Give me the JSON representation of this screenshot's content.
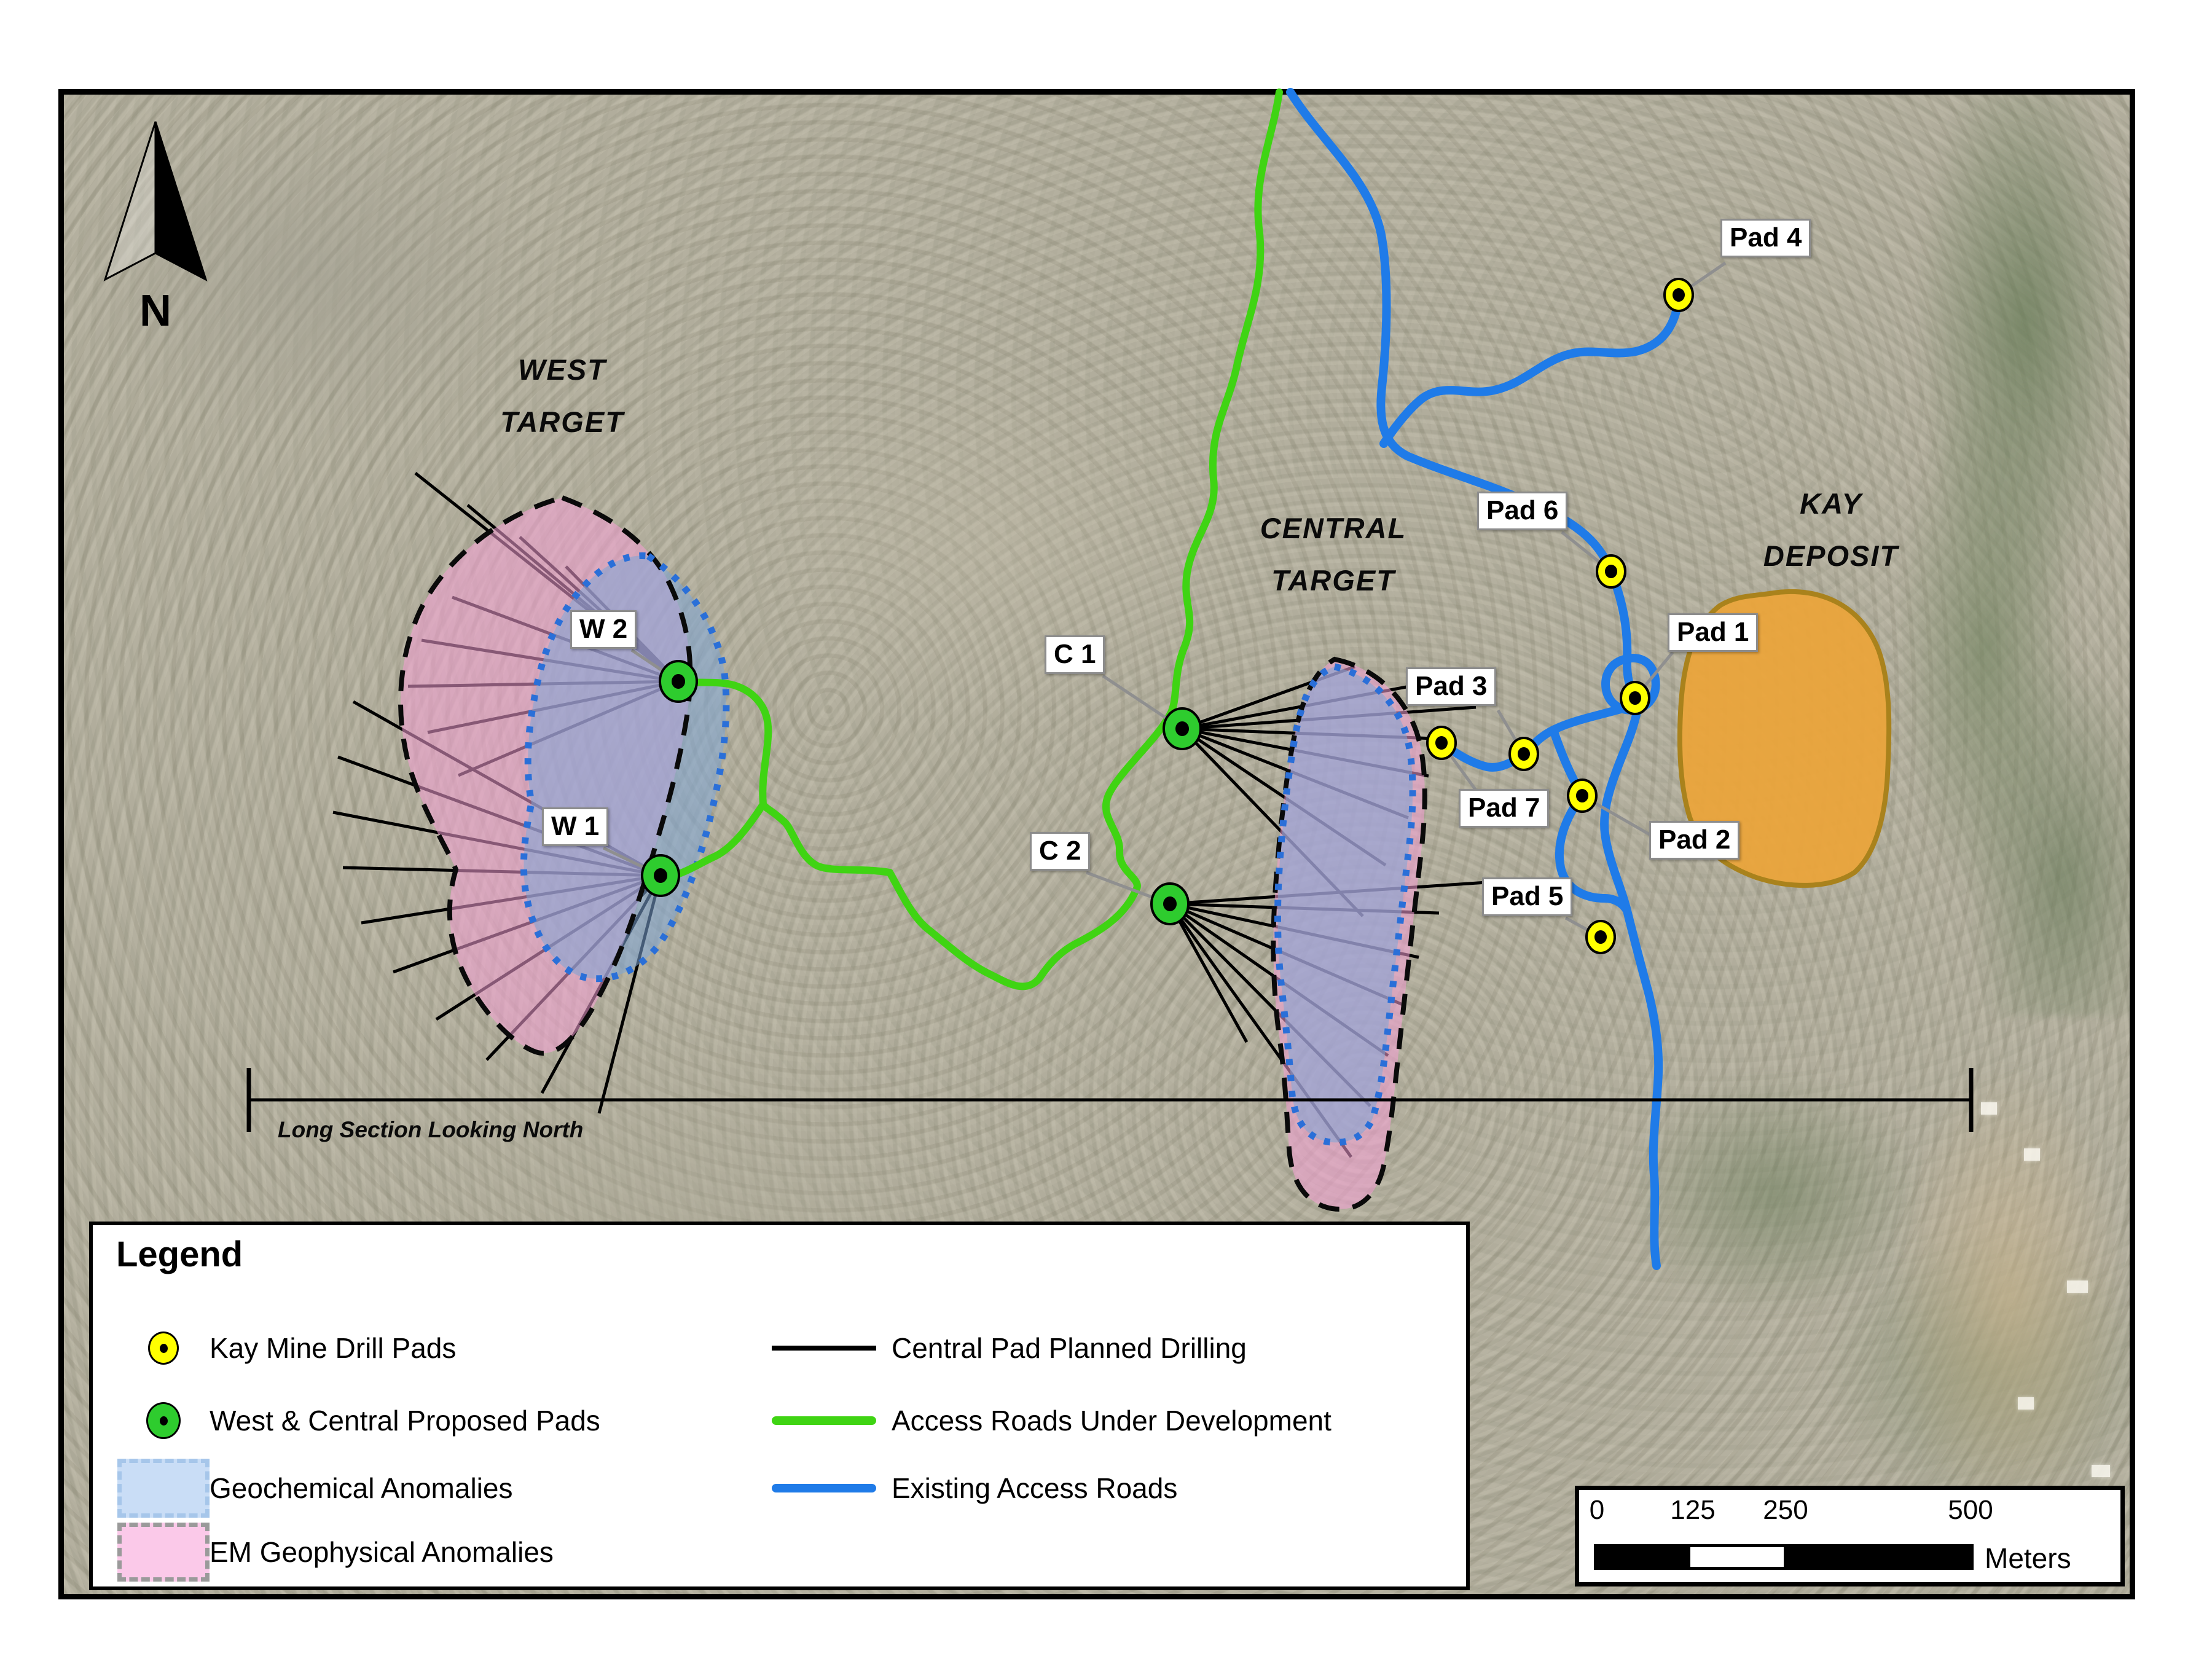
{
  "north": {
    "label": "N"
  },
  "targets": {
    "west": {
      "line1": "WEST",
      "line2": "TARGET"
    },
    "central": {
      "line1": "CENTRAL",
      "line2": "TARGET"
    },
    "kay": {
      "line1": "KAY",
      "line2": "DEPOSIT"
    }
  },
  "section": {
    "label": "Long Section Looking North"
  },
  "pads": {
    "kay_mine": [
      {
        "label": "Pad 4"
      },
      {
        "label": "Pad 6"
      },
      {
        "label": "Pad 1"
      },
      {
        "label": "Pad 3"
      },
      {
        "label": "Pad 7"
      },
      {
        "label": "Pad 2"
      },
      {
        "label": "Pad 5"
      }
    ],
    "proposed": [
      {
        "label": "W 2"
      },
      {
        "label": "W 1"
      },
      {
        "label": "C 1"
      },
      {
        "label": "C 2"
      }
    ]
  },
  "legend": {
    "title": "Legend",
    "items_left": [
      {
        "symbol": "yellow-pad-icon",
        "label": "Kay Mine Drill Pads"
      },
      {
        "symbol": "green-pad-icon",
        "label": "West & Central Proposed Pads"
      },
      {
        "symbol": "blue-swatch-icon",
        "label": "Geochemical Anomalies"
      },
      {
        "symbol": "pink-swatch-icon",
        "label": "EM Geophysical Anomalies"
      }
    ],
    "items_right": [
      {
        "symbol": "black-line-icon",
        "label": "Central Pad Planned Drilling"
      },
      {
        "symbol": "green-line-icon",
        "label": "Access Roads Under Development"
      },
      {
        "symbol": "blue-line-icon",
        "label": "Existing Access Roads"
      }
    ]
  },
  "scalebar": {
    "ticks": [
      "0",
      "125",
      "250",
      "500"
    ],
    "unit": "Meters"
  },
  "colors": {
    "em_anomaly": "#F6A0D6",
    "geochem_anomaly": "#7DA5D7",
    "deposit_fill": "#EAA43B",
    "road_under_development": "#3FD413",
    "existing_road": "#1F7BE8",
    "kay_pad": "#FFFF00",
    "proposed_pad": "#2ECC2E",
    "planned_drilling": "#000000"
  }
}
